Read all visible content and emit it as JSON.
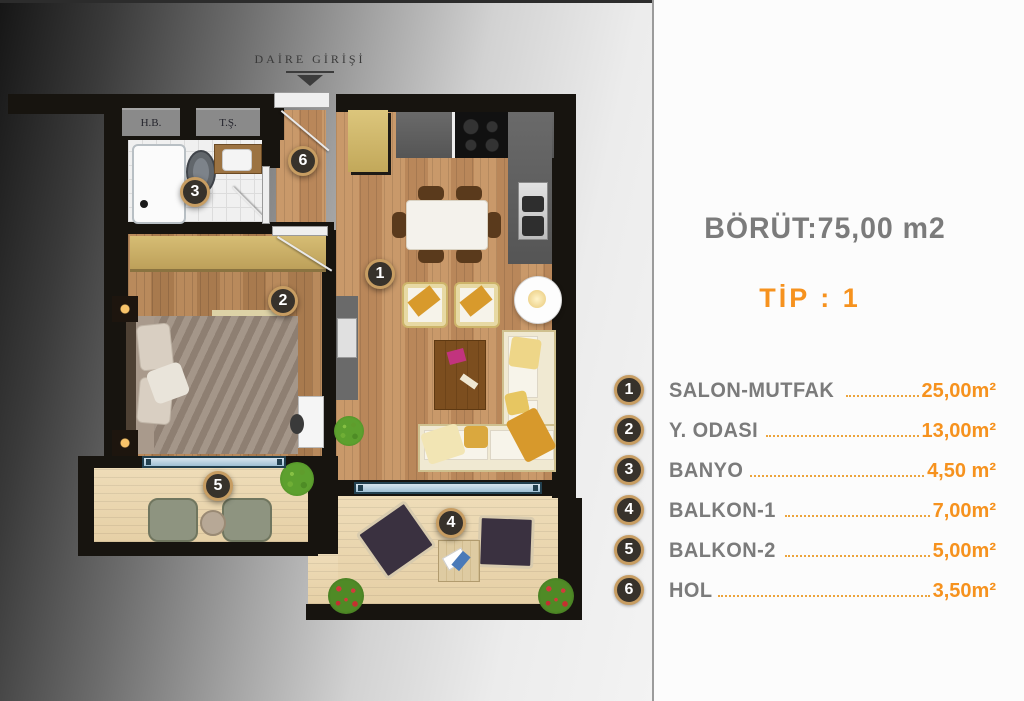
{
  "colors": {
    "accent_orange": "#F6921E",
    "leader_orange": "#ECA43C",
    "label_gray": "#7B7B7B",
    "circle_ring": "#C79D62",
    "circle_fill": "#37322B",
    "wall_black": "#17140F",
    "window_blue": "#22404F"
  },
  "panel": {
    "title": "BÖRÜT:75,00 m2",
    "subtitle": "TİP : 1",
    "rooms": [
      {
        "num": "1",
        "label": "SALON-MUTFAK",
        "area": "25,00m²"
      },
      {
        "num": "2",
        "label": "Y. ODASI",
        "area": "13,00m²"
      },
      {
        "num": "3",
        "label": "BANYO",
        "area": "4,50 m²"
      },
      {
        "num": "4",
        "label": "BALKON-1",
        "area": "7,00m²"
      },
      {
        "num": "5",
        "label": "BALKON-2",
        "area": "5,00m²"
      },
      {
        "num": "6",
        "label": "HOL",
        "area": "3,50m²"
      }
    ]
  },
  "plan": {
    "entrance_label": "DAİRE GİRİŞİ",
    "shafts": {
      "hb": "H.B.",
      "ts": "T.Ş."
    },
    "markers": [
      "1",
      "2",
      "3",
      "4",
      "5",
      "6"
    ]
  }
}
